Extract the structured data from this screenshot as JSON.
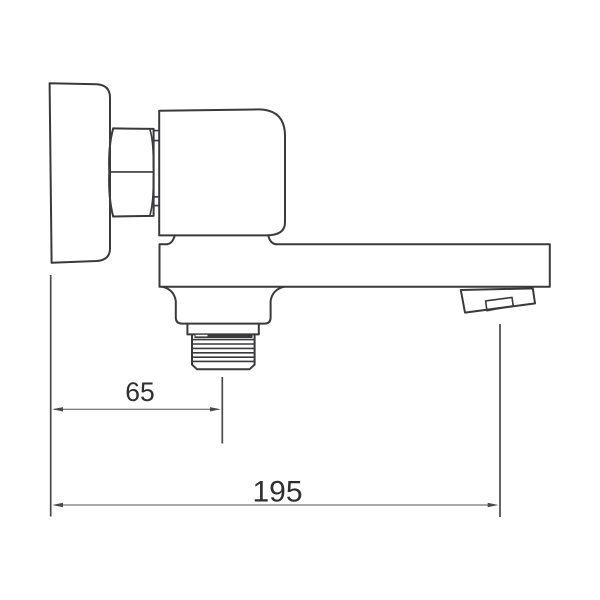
{
  "page": {
    "background_color": "#ffffff"
  },
  "drawing": {
    "subject": "wall-mounted-faucet-spout-side-view",
    "line_color": "#3a3a3c",
    "dimension_line_color": "#4a4a4c",
    "text_color": "#2e2e30"
  },
  "dimensions": {
    "spout_offset": {
      "value": "65"
    },
    "overall_length": {
      "value": "195"
    }
  }
}
